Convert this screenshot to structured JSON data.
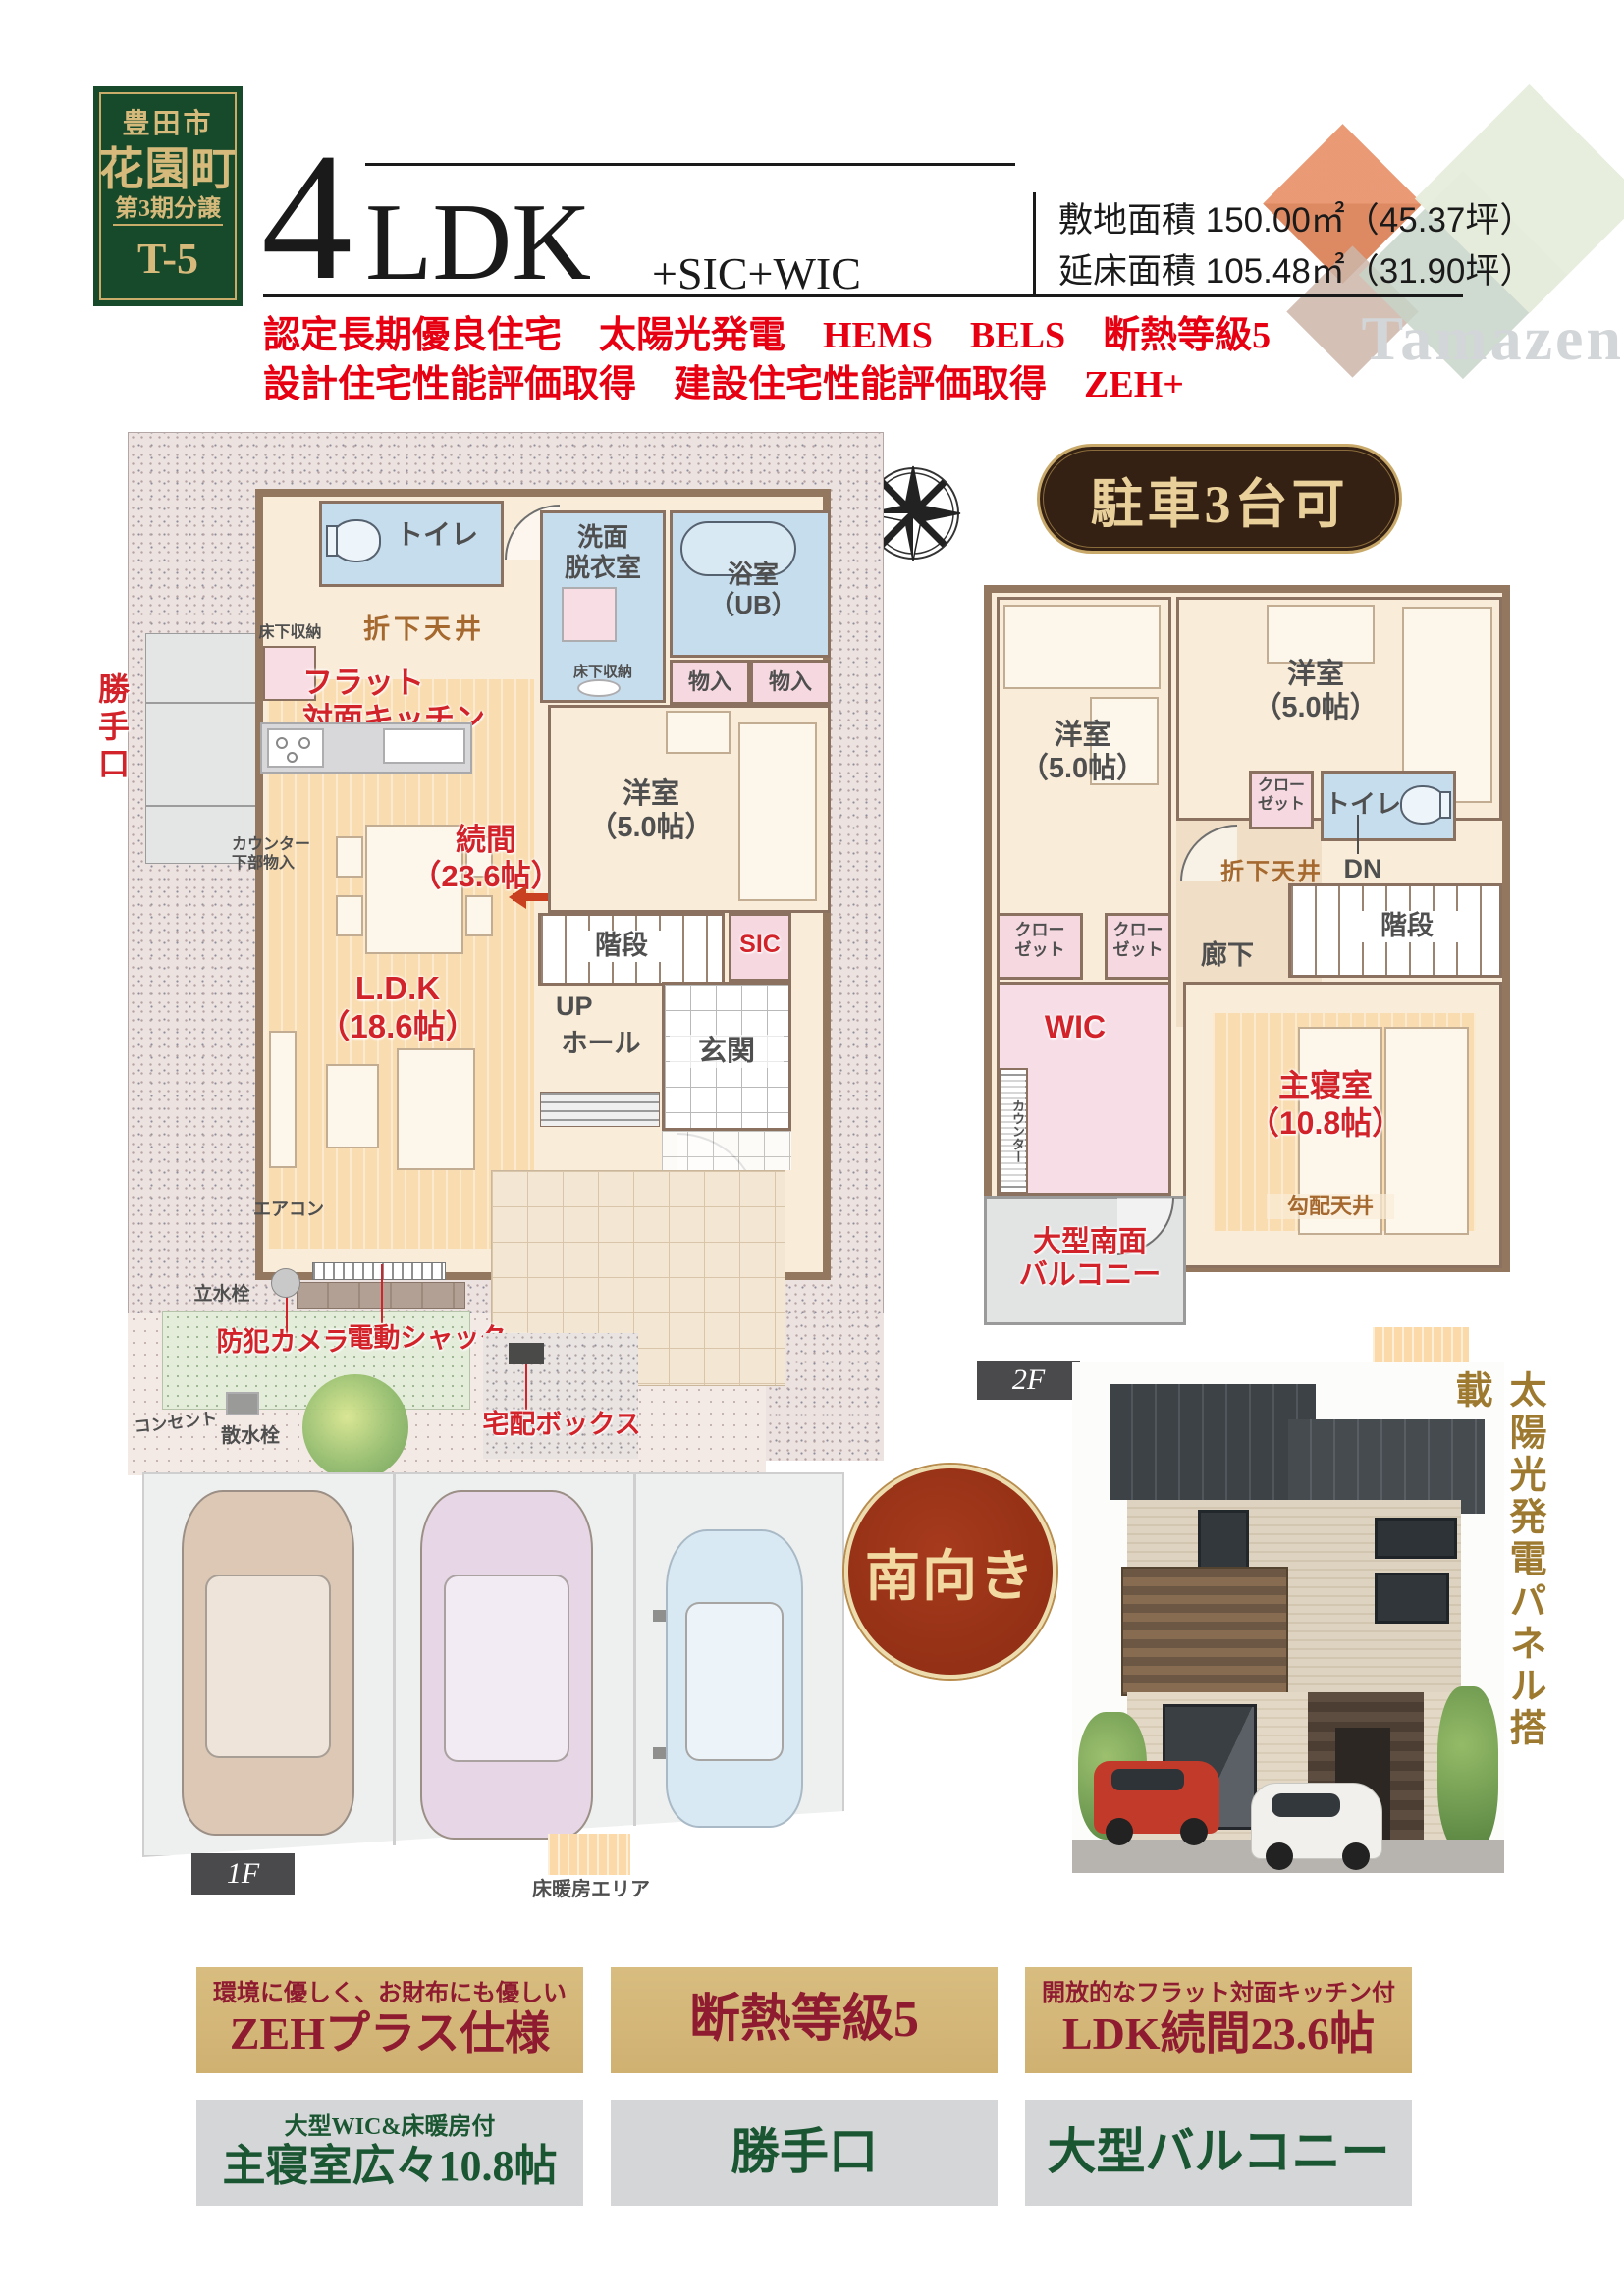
{
  "header": {
    "badge": {
      "city": "豊田市",
      "town": "花園町",
      "phase": "第3期分譲",
      "lot": "T-5"
    },
    "title": {
      "number": "4",
      "ldk": "LDK",
      "suffix": "+SIC+WIC"
    },
    "specs": [
      {
        "label": "敷地面積",
        "value": "150.00㎡（45.37坪）"
      },
      {
        "label": "延床面積",
        "value": "105.48㎡（31.90坪）"
      }
    ],
    "features_line1": "認定長期優良住宅　太陽光発電　HEMS　BELS　断熱等級5",
    "features_line2": "設計住宅性能評価取得　建設住宅性能評価取得　ZEH+",
    "logo_text": "Tamazen"
  },
  "compass_label": "N",
  "badges": {
    "parking": "駐車3台可",
    "facing": "南向き",
    "solar_vertical": "太陽光発電パネル搭載"
  },
  "legend": {
    "floor_heating": "床暖房エリア"
  },
  "plan1f": {
    "floor_label": "1F",
    "rooms": {
      "toilet": "トイレ",
      "washroom": "洗面\n脱衣室",
      "bath": "浴室\n（UB）",
      "storage_a": "物入",
      "storage_b": "物入",
      "western_room": "洋室\n（5.0帖）",
      "tsuzukima": "続間\n（23.6帖）",
      "ldk": "L.D.K\n（18.6帖）",
      "stairs": "階段",
      "up": "UP",
      "hall": "ホール",
      "sic": "SIC",
      "entrance": "玄関"
    },
    "annotations": {
      "underfloor_storage_kitchen": "床下収納",
      "underfloor_storage_wash": "床下収納",
      "lowered_ceiling": "折下天井",
      "flat_kitchen": "フラット\n対面キッチン",
      "back_door": "勝手口",
      "counter_storage": "カウンター\n下部物入",
      "aircon": "エアコン",
      "faucet": "立水栓",
      "security_camera": "防犯カメラ",
      "electric_shutter": "電動シャッター",
      "outlet": "コンセント",
      "sprinkler": "散水栓",
      "delivery_box": "宅配ボックス"
    }
  },
  "plan2f": {
    "floor_label": "2F",
    "rooms": {
      "western_a": "洋室\n（5.0帖）",
      "western_b": "洋室\n（5.0帖）",
      "closet_a": "クロー\nゼット",
      "closet_b": "クロー\nゼット",
      "closet_c": "クロー\nゼット",
      "toilet": "トイレ",
      "corridor": "廊下",
      "stairs": "階段",
      "wic": "WIC",
      "master": "主寝室\n（10.8帖）",
      "balcony": "大型南面\nバルコニー"
    },
    "annotations": {
      "lowered_ceiling": "折下天井",
      "dn": "DN",
      "counter": "カウンター",
      "sloped_ceiling": "勾配天井"
    }
  },
  "feature_boxes": {
    "row1": [
      {
        "top": "環境に優しく、お財布にも優しい",
        "main": "ZEHプラス仕様"
      },
      {
        "top": "",
        "main": "断熱等級5"
      },
      {
        "top": "開放的なフラット対面キッチン付",
        "main": "LDK続間23.6帖"
      }
    ],
    "row2": [
      {
        "top": "大型WIC&床暖房付",
        "main": "主寝室広々10.8帖"
      },
      {
        "top": "",
        "main": "勝手口"
      },
      {
        "top": "",
        "main": "大型バルコニー"
      }
    ]
  },
  "colors": {
    "accent_red": "#e60012",
    "flyer_dark_red": "#8e1b30",
    "gold_panel": "#d2b473",
    "deep_green": "#1a5632",
    "badge_green": "#17492b",
    "plan_red": "#d2232a",
    "pill_brown": "#342113"
  }
}
